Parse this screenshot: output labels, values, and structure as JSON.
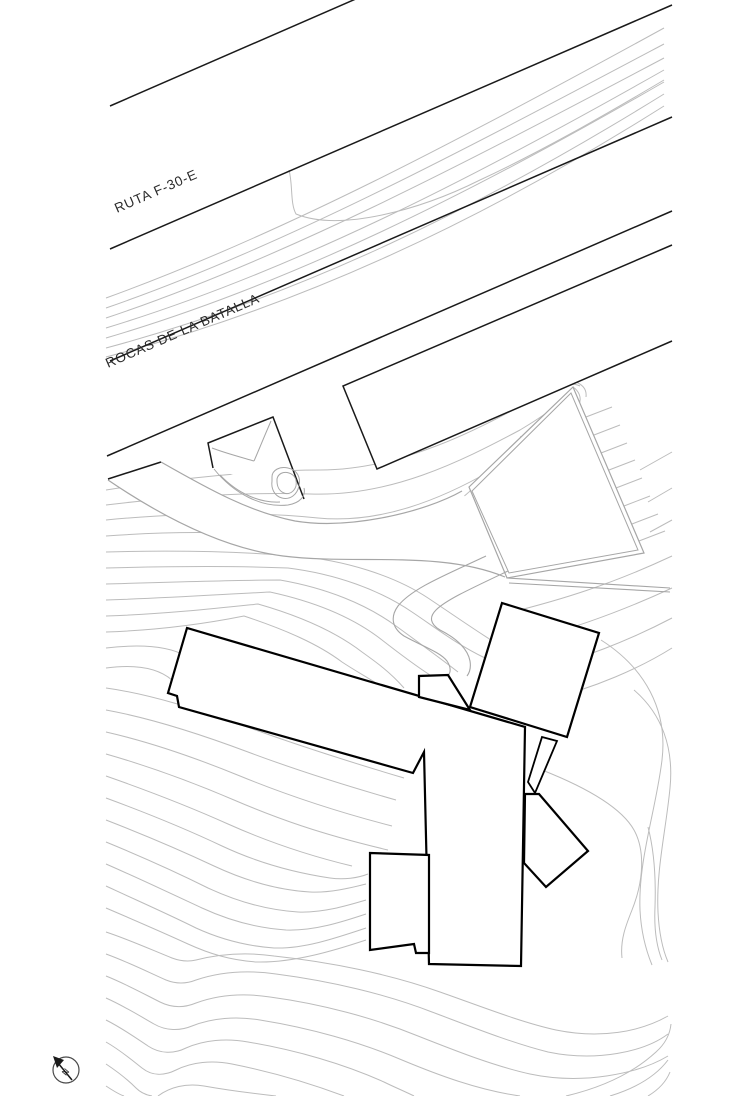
{
  "drawing": {
    "type": "architectural-site-plan",
    "labels": {
      "road_upper": "RUTA F-30-E",
      "road_lower": "ROCAS DE LA BATALLA"
    },
    "north": {
      "letter": "N"
    },
    "colors": {
      "background": "#ffffff",
      "ink": "#1a1a1a",
      "building": "#000000",
      "contour": "#bcbcbc",
      "detail": "#a6a6a6",
      "label": "#2b2b2b"
    }
  }
}
